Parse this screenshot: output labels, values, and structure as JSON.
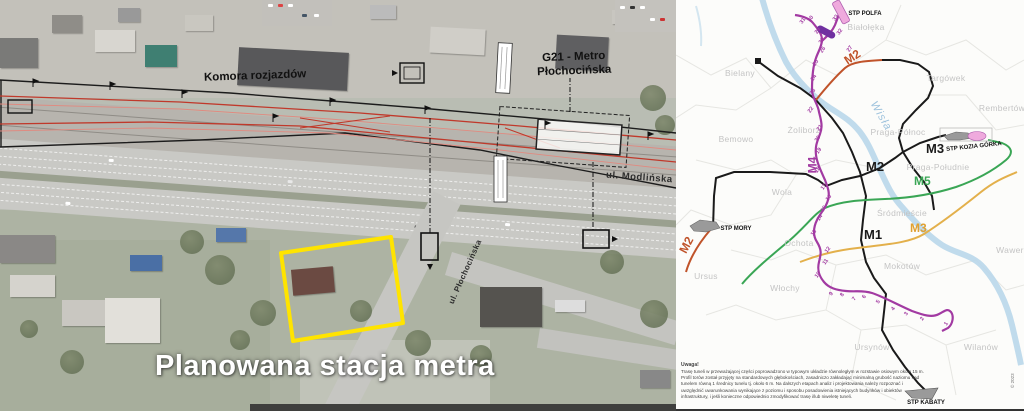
{
  "left_panel": {
    "labels": {
      "komora_rozjazdow": "Komora rozjazdów",
      "g21_line1": "G21 - Metro",
      "g21_line2": "Płochocińska",
      "ul_modlinska": "ul. Modlińska",
      "ul_plochocinska": "ul. Płochocińska"
    },
    "caption": "Planowana stacja metra",
    "site_outline_color": "#ffe400",
    "track_color": "#c0392b"
  },
  "map_panel": {
    "river_label": "Wisła",
    "copyright": "© 2023",
    "colors": {
      "m1": "#1a1a1a",
      "m2_existing": "#1a1a1a",
      "m2_extension": "#c0532a",
      "m3": "#e3b04b",
      "m4": "#a23aa2",
      "m4_dark": "#7030a0",
      "m5": "#3aa655",
      "river": "#b9d7ea",
      "depot_pink": "#efaadd",
      "depot_gray": "#9a9a9a",
      "district_text": "#c4c4c4"
    },
    "districts": [
      {
        "name": "Bielany",
        "x": 64,
        "y": 73
      },
      {
        "name": "Białołęka",
        "x": 190,
        "y": 27
      },
      {
        "name": "Targówek",
        "x": 270,
        "y": 78
      },
      {
        "name": "Rembertów",
        "x": 326,
        "y": 108
      },
      {
        "name": "Bemowo",
        "x": 60,
        "y": 139
      },
      {
        "name": "Żoliborz",
        "x": 128,
        "y": 130
      },
      {
        "name": "Praga-Północ",
        "x": 222,
        "y": 132
      },
      {
        "name": "Wola",
        "x": 106,
        "y": 192
      },
      {
        "name": "Śródmieście",
        "x": 226,
        "y": 213
      },
      {
        "name": "Praga-Południe",
        "x": 262,
        "y": 167
      },
      {
        "name": "Ochota",
        "x": 123,
        "y": 243
      },
      {
        "name": "Ursus",
        "x": 30,
        "y": 276
      },
      {
        "name": "Włochy",
        "x": 109,
        "y": 288
      },
      {
        "name": "Mokotów",
        "x": 226,
        "y": 266
      },
      {
        "name": "Wawer",
        "x": 334,
        "y": 250
      },
      {
        "name": "Ursynów",
        "x": 196,
        "y": 347
      },
      {
        "name": "Wilanów",
        "x": 305,
        "y": 347
      }
    ],
    "line_labels": [
      {
        "text": "M2",
        "x": 168,
        "y": 50,
        "rot": -33,
        "color": "#c0532a",
        "size": 12
      },
      {
        "text": "M2",
        "x": 2,
        "y": 238,
        "rot": -62,
        "color": "#c0532a",
        "size": 12
      },
      {
        "text": "M2",
        "x": 190,
        "y": 159,
        "rot": 0,
        "color": "#1a1a1a",
        "size": 13
      },
      {
        "text": "M1",
        "x": 188,
        "y": 227,
        "rot": 0,
        "color": "#1a1a1a",
        "size": 13
      },
      {
        "text": "M3",
        "x": 250,
        "y": 141,
        "rot": 0,
        "color": "#1a1a1a",
        "size": 13
      },
      {
        "text": "M3",
        "x": 234,
        "y": 221,
        "rot": 0,
        "color": "#e0a030",
        "size": 12
      },
      {
        "text": "M5",
        "x": 238,
        "y": 174,
        "rot": 0,
        "color": "#3aa655",
        "size": 12
      },
      {
        "text": "M4",
        "x": 128,
        "y": 158,
        "rot": -90,
        "color": "#a23aa2",
        "size": 12
      }
    ],
    "depots": [
      {
        "name": "STP POLFA",
        "x": 189,
        "y": 14,
        "rot": 0
      },
      {
        "name": "STP KOZIA GÓRKA",
        "x": 298,
        "y": 147,
        "rot": -6
      },
      {
        "name": "STP MORY",
        "x": 60,
        "y": 229,
        "rot": 0
      },
      {
        "name": "STP KABATY",
        "x": 250,
        "y": 403,
        "rot": 0
      }
    ],
    "station_numbers": [
      {
        "n": "1",
        "x": 269,
        "y": 321
      },
      {
        "n": "2",
        "x": 245,
        "y": 316
      },
      {
        "n": "3",
        "x": 229,
        "y": 311
      },
      {
        "n": "4",
        "x": 216,
        "y": 306
      },
      {
        "n": "5",
        "x": 201,
        "y": 299
      },
      {
        "n": "6",
        "x": 187,
        "y": 294
      },
      {
        "n": "7",
        "x": 177,
        "y": 296
      },
      {
        "n": "8",
        "x": 165,
        "y": 292
      },
      {
        "n": "9",
        "x": 154,
        "y": 291
      },
      {
        "n": "10",
        "x": 139,
        "y": 272
      },
      {
        "n": "11",
        "x": 147,
        "y": 259
      },
      {
        "n": "12",
        "x": 149,
        "y": 247
      },
      {
        "n": "13",
        "x": 135,
        "y": 230
      },
      {
        "n": "14",
        "x": 141,
        "y": 215
      },
      {
        "n": "15",
        "x": 145,
        "y": 206
      },
      {
        "n": "16",
        "x": 150,
        "y": 195
      },
      {
        "n": "17",
        "x": 145,
        "y": 184
      },
      {
        "n": "18",
        "x": 139,
        "y": 167
      },
      {
        "n": "19",
        "x": 140,
        "y": 148
      },
      {
        "n": "20",
        "x": 139,
        "y": 136
      },
      {
        "n": "21",
        "x": 141,
        "y": 125
      },
      {
        "n": "22",
        "x": 132,
        "y": 107
      },
      {
        "n": "23",
        "x": 134,
        "y": 89
      },
      {
        "n": "24",
        "x": 135,
        "y": 75
      },
      {
        "n": "25",
        "x": 137,
        "y": 60
      },
      {
        "n": "26",
        "x": 144,
        "y": 47
      },
      {
        "n": "27",
        "x": 171,
        "y": 46
      },
      {
        "n": "28",
        "x": 143,
        "y": 38
      },
      {
        "n": "29",
        "x": 139,
        "y": 28
      },
      {
        "n": "30",
        "x": 132,
        "y": 16
      },
      {
        "n": "31",
        "x": 124,
        "y": 18
      },
      {
        "n": "32",
        "x": 161,
        "y": 29
      },
      {
        "n": "33",
        "x": 157,
        "y": 15
      }
    ],
    "note": {
      "title": "Uwaga!",
      "lines": [
        "Trasę tuneli w przeważającej części poprowadzono w typowym układzie równoległym w rozstawie osiowym około 15 m.",
        "Profil torów został przyjęty na standardowych głębokościach, zasadniczo zakładając minimalną grubość naziomu nad",
        "tunelem równą 1 średnicy tunelu tj. około 6 m. Na dalszych etapach analiz i projektowania należy rozpoznać i",
        "uwzględnić uwarunkowania wynikające z poziomu i sposobu posadowienia istniejących budynków i obiektów",
        "infrastruktury, i jeśli konieczne odpowiednio zmodyfikować trasę i/lub niweletę tuneli."
      ]
    }
  }
}
